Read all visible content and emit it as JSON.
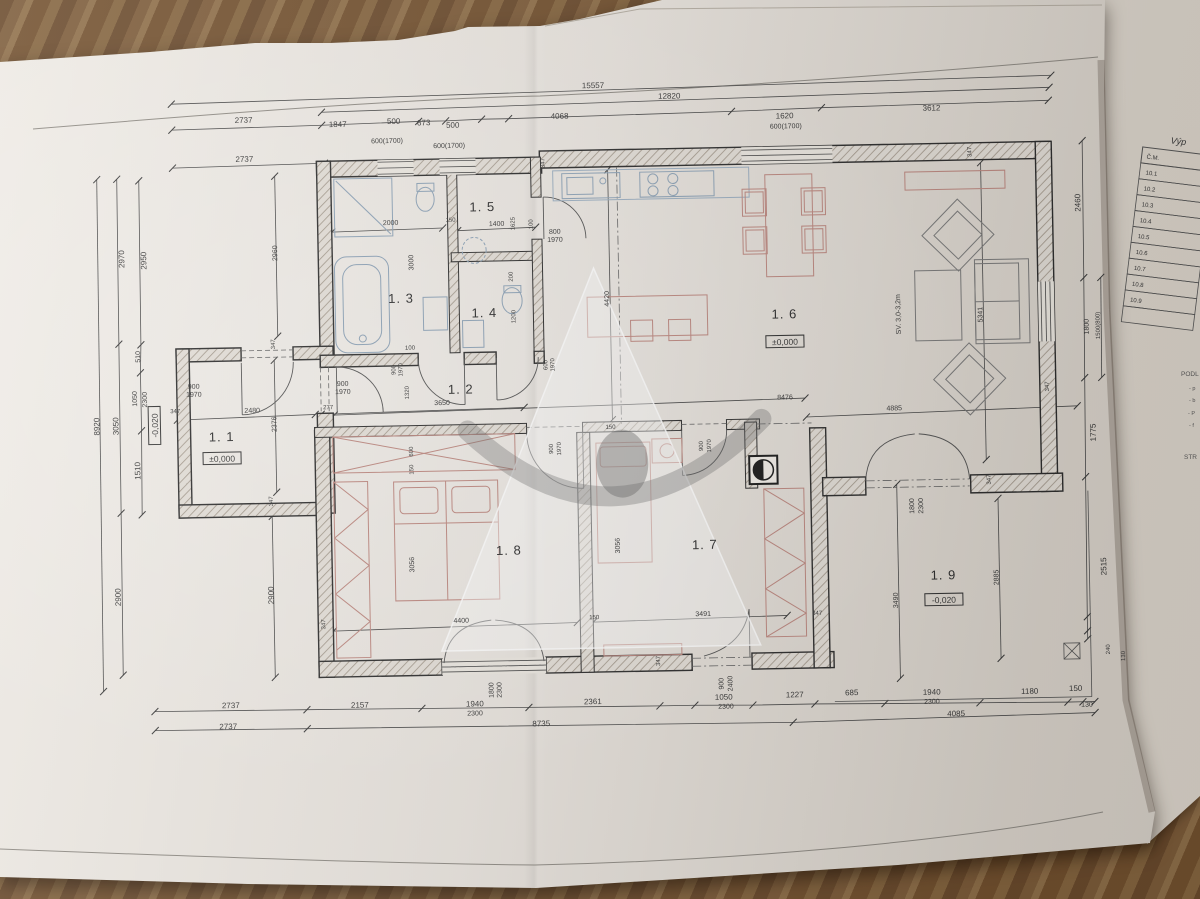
{
  "colors": {
    "wood": "#7a583a",
    "paper": "#e9e4dd",
    "paper_side": "#e3ddd4",
    "ink": "#3c3c3c",
    "furniture_red": "#bf8a82",
    "fixture_blue": "#8fa4b8",
    "watermark_gray": "#6e6e6e"
  },
  "rooms": [
    {
      "label": "1. 1",
      "x": 222,
      "y": 434
    },
    {
      "label": "1. 2",
      "x": 462,
      "y": 391
    },
    {
      "label": "1. 3",
      "x": 404,
      "y": 299
    },
    {
      "label": "1. 4",
      "x": 487,
      "y": 315
    },
    {
      "label": "1. 5",
      "x": 487,
      "y": 209
    },
    {
      "label": "1. 6",
      "x": 787,
      "y": 322
    },
    {
      "label": "1. 7",
      "x": 703,
      "y": 551
    },
    {
      "label": "1. 8",
      "x": 507,
      "y": 553
    },
    {
      "label": "1. 9",
      "x": 941,
      "y": 586
    }
  ],
  "elevations": [
    {
      "t": "±0,000",
      "x": 222,
      "y": 453
    },
    {
      "t": "±0,000",
      "x": 787,
      "y": 347
    },
    {
      "t": "-0,020",
      "x": 941,
      "y": 608
    },
    {
      "t": "-0,020",
      "x": 157,
      "y": 417,
      "r": -90
    }
  ],
  "ceiling_note": {
    "t": "SV. 3,0-3,2m",
    "x": 903,
    "y": 320,
    "r": -90
  },
  "dims": [
    {
      "t": "15557",
      "x": 600,
      "y": 88
    },
    {
      "t": "12820",
      "x": 676,
      "y": 100
    },
    {
      "t": "2737",
      "x": 250,
      "y": 116
    },
    {
      "t": "1847",
      "x": 344,
      "y": 122
    },
    {
      "t": "500",
      "x": 400,
      "y": 120
    },
    {
      "t": "673",
      "x": 430,
      "y": 122
    },
    {
      "t": "500",
      "x": 459,
      "y": 125
    },
    {
      "t": "4068",
      "x": 566,
      "y": 118
    },
    {
      "t": "1620",
      "x": 791,
      "y": 122
    },
    {
      "t": "3612",
      "x": 938,
      "y": 117
    },
    {
      "t": "2737",
      "x": 250,
      "y": 155
    },
    {
      "t": "600(1700)",
      "x": 393,
      "y": 139,
      "s": 7
    },
    {
      "t": "600(1700)",
      "x": 455,
      "y": 145,
      "s": 7
    },
    {
      "t": "600(1700)",
      "x": 792,
      "y": 132,
      "s": 7
    },
    {
      "t": "2737",
      "x": 226,
      "y": 701
    },
    {
      "t": "2157",
      "x": 355,
      "y": 703
    },
    {
      "t": "1940",
      "x": 470,
      "y": 704
    },
    {
      "t": "2300",
      "x": 470,
      "y": 713,
      "s": 7
    },
    {
      "t": "2361",
      "x": 588,
      "y": 704
    },
    {
      "t": "1050",
      "x": 719,
      "y": 702
    },
    {
      "t": "2300",
      "x": 721,
      "y": 711,
      "s": 7
    },
    {
      "t": "1227",
      "x": 790,
      "y": 701
    },
    {
      "t": "685",
      "x": 847,
      "y": 700
    },
    {
      "t": "1940",
      "x": 927,
      "y": 701
    },
    {
      "t": "2300",
      "x": 927,
      "y": 710,
      "s": 7
    },
    {
      "t": "1180",
      "x": 1025,
      "y": 702
    },
    {
      "t": "150",
      "x": 1071,
      "y": 700
    },
    {
      "t": "130",
      "x": 1082,
      "y": 716,
      "s": 7
    },
    {
      "t": "2737",
      "x": 223,
      "y": 722
    },
    {
      "t": "8735",
      "x": 536,
      "y": 725
    },
    {
      "t": "4085",
      "x": 951,
      "y": 723
    },
    {
      "t": "1800",
      "x": 489,
      "y": 688,
      "r": -90,
      "s": 7
    },
    {
      "t": "2300",
      "x": 497,
      "y": 688,
      "r": -90,
      "s": 7
    },
    {
      "t": "900",
      "x": 719,
      "y": 686,
      "r": -90,
      "s": 7
    },
    {
      "t": "2400",
      "x": 728,
      "y": 686,
      "r": -90,
      "s": 7
    },
    {
      "t": "8920",
      "x": 100,
      "y": 417,
      "r": -90
    },
    {
      "t": "3050",
      "x": 119,
      "y": 417,
      "r": -90
    },
    {
      "t": "2900",
      "x": 118,
      "y": 588,
      "r": -90
    },
    {
      "t": "2970",
      "x": 128,
      "y": 250,
      "r": -90
    },
    {
      "t": "2950",
      "x": 150,
      "y": 252,
      "r": -90
    },
    {
      "t": "510",
      "x": 142,
      "y": 348,
      "r": -90,
      "s": 7
    },
    {
      "t": "1050",
      "x": 138,
      "y": 390,
      "r": -90,
      "s": 7
    },
    {
      "t": "2300",
      "x": 148,
      "y": 391,
      "r": -90,
      "s": 7
    },
    {
      "t": "1510",
      "x": 140,
      "y": 462,
      "r": -90
    },
    {
      "t": "2960",
      "x": 281,
      "y": 247,
      "r": -90,
      "s": 7
    },
    {
      "t": "2376",
      "x": 277,
      "y": 418,
      "r": -90,
      "s": 7
    },
    {
      "t": "2900",
      "x": 271,
      "y": 589,
      "r": -90
    },
    {
      "t": "2460",
      "x": 1085,
      "y": 212,
      "r": -90
    },
    {
      "t": "1800",
      "x": 1091,
      "y": 336,
      "r": -90,
      "s": 7
    },
    {
      "t": "1500(800)",
      "x": 1102,
      "y": 335,
      "r": -90,
      "s": 6
    },
    {
      "t": "1775",
      "x": 1096,
      "y": 442,
      "r": -90
    },
    {
      "t": "2515",
      "x": 1104,
      "y": 576,
      "r": -90
    },
    {
      "t": "240",
      "x": 1106,
      "y": 659,
      "r": -90,
      "s": 6
    },
    {
      "t": "130",
      "x": 1121,
      "y": 666,
      "r": -90,
      "s": 6
    },
    {
      "t": "5341",
      "x": 985,
      "y": 322,
      "r": -90,
      "s": 7
    },
    {
      "t": "4885",
      "x": 895,
      "y": 416,
      "s": 7
    },
    {
      "t": "8476",
      "x": 786,
      "y": 403,
      "s": 7
    },
    {
      "t": "4420",
      "x": 612,
      "y": 299,
      "r": -90,
      "s": 7
    },
    {
      "t": "2885",
      "x": 996,
      "y": 585,
      "r": -90,
      "s": 7
    },
    {
      "t": "3490",
      "x": 895,
      "y": 606,
      "r": -90,
      "s": 7
    },
    {
      "t": "1800",
      "x": 913,
      "y": 512,
      "r": -90,
      "s": 7
    },
    {
      "t": "2300",
      "x": 922,
      "y": 512,
      "r": -90,
      "s": 7
    },
    {
      "t": "2000",
      "x": 395,
      "y": 221,
      "s": 7
    },
    {
      "t": "150",
      "x": 455,
      "y": 219,
      "s": 6
    },
    {
      "t": "1400",
      "x": 501,
      "y": 224,
      "s": 7
    },
    {
      "t": "1625",
      "x": 519,
      "y": 222,
      "r": -90,
      "s": 6
    },
    {
      "t": "100",
      "x": 537,
      "y": 223,
      "r": -90,
      "s": 6
    },
    {
      "t": "800",
      "x": 559,
      "y": 233,
      "s": 7
    },
    {
      "t": "1970",
      "x": 559,
      "y": 241,
      "s": 7
    },
    {
      "t": "3000",
      "x": 417,
      "y": 259,
      "r": -90,
      "s": 7
    },
    {
      "t": "200",
      "x": 516,
      "y": 275,
      "r": -90,
      "s": 6
    },
    {
      "t": "1200",
      "x": 518,
      "y": 315,
      "r": -90,
      "s": 6
    },
    {
      "t": "100",
      "x": 412,
      "y": 346,
      "s": 6
    },
    {
      "t": "900",
      "x": 397,
      "y": 366,
      "r": -90,
      "s": 6
    },
    {
      "t": "1970",
      "x": 404,
      "y": 366,
      "r": -90,
      "s": 6
    },
    {
      "t": "1320",
      "x": 410,
      "y": 389,
      "r": -90,
      "s": 6
    },
    {
      "t": "600",
      "x": 549,
      "y": 364,
      "r": -90,
      "s": 6
    },
    {
      "t": "1970",
      "x": 556,
      "y": 364,
      "r": -90,
      "s": 6
    },
    {
      "t": "3650",
      "x": 443,
      "y": 402,
      "s": 7
    },
    {
      "t": "900",
      "x": 195,
      "y": 381,
      "s": 7
    },
    {
      "t": "1970",
      "x": 195,
      "y": 389,
      "s": 7
    },
    {
      "t": "900",
      "x": 344,
      "y": 381,
      "s": 7
    },
    {
      "t": "1970",
      "x": 344,
      "y": 389,
      "s": 7
    },
    {
      "t": "2480",
      "x": 253,
      "y": 406,
      "s": 7
    },
    {
      "t": "277",
      "x": 329,
      "y": 404,
      "s": 6
    },
    {
      "t": "600",
      "x": 413,
      "y": 448,
      "r": -90,
      "s": 6
    },
    {
      "t": "150",
      "x": 413,
      "y": 466,
      "r": -90,
      "s": 6
    },
    {
      "t": "150",
      "x": 611,
      "y": 429,
      "s": 6
    },
    {
      "t": "900",
      "x": 553,
      "y": 448,
      "r": -90,
      "s": 6
    },
    {
      "t": "1970",
      "x": 561,
      "y": 448,
      "r": -90,
      "s": 6
    },
    {
      "t": "900",
      "x": 703,
      "y": 448,
      "r": -90,
      "s": 6
    },
    {
      "t": "1970",
      "x": 711,
      "y": 448,
      "r": -90,
      "s": 6
    },
    {
      "t": "3056",
      "x": 412,
      "y": 561,
      "r": -90,
      "s": 7
    },
    {
      "t": "3056",
      "x": 618,
      "y": 546,
      "r": -90,
      "s": 7
    },
    {
      "t": "4400",
      "x": 458,
      "y": 620,
      "s": 7
    },
    {
      "t": "3491",
      "x": 700,
      "y": 618,
      "s": 7
    },
    {
      "t": "150",
      "x": 591,
      "y": 619,
      "s": 6
    },
    {
      "t": "347",
      "x": 176,
      "y": 405,
      "s": 6
    },
    {
      "t": "347",
      "x": 277,
      "y": 338,
      "r": -90,
      "s": 6
    },
    {
      "t": "347",
      "x": 272,
      "y": 495,
      "r": -90,
      "s": 6
    },
    {
      "t": "347",
      "x": 550,
      "y": 162,
      "r": -90,
      "s": 6
    },
    {
      "t": "347",
      "x": 977,
      "y": 159,
      "r": -90,
      "s": 6
    },
    {
      "t": "347",
      "x": 1050,
      "y": 395,
      "r": -90,
      "s": 6
    },
    {
      "t": "347",
      "x": 322,
      "y": 619,
      "r": -90,
      "s": 6
    },
    {
      "t": "347",
      "x": 656,
      "y": 662,
      "r": -90,
      "s": 6
    },
    {
      "t": "347",
      "x": 814,
      "y": 619,
      "s": 6
    },
    {
      "t": "347",
      "x": 990,
      "y": 487,
      "r": -90,
      "s": 6
    }
  ],
  "side_table": {
    "title": "Výp",
    "header": "Č.M.",
    "rows": [
      "10.1",
      "10.2",
      "10.3",
      "10.4",
      "10.5",
      "10.6",
      "10.7",
      "10.8",
      "10.9"
    ]
  },
  "side_notes": [
    {
      "t": "PODL",
      "x": 1181,
      "y": 376,
      "s": 6.5
    },
    {
      "t": "- p",
      "x": 1189,
      "y": 390,
      "s": 5.5
    },
    {
      "t": "- b",
      "x": 1189,
      "y": 402,
      "s": 5.5
    },
    {
      "t": "- P",
      "x": 1188,
      "y": 415,
      "s": 5.5
    },
    {
      "t": "- f",
      "x": 1189,
      "y": 427,
      "s": 5.5
    },
    {
      "t": "STR",
      "x": 1184,
      "y": 459,
      "s": 6.5
    }
  ]
}
